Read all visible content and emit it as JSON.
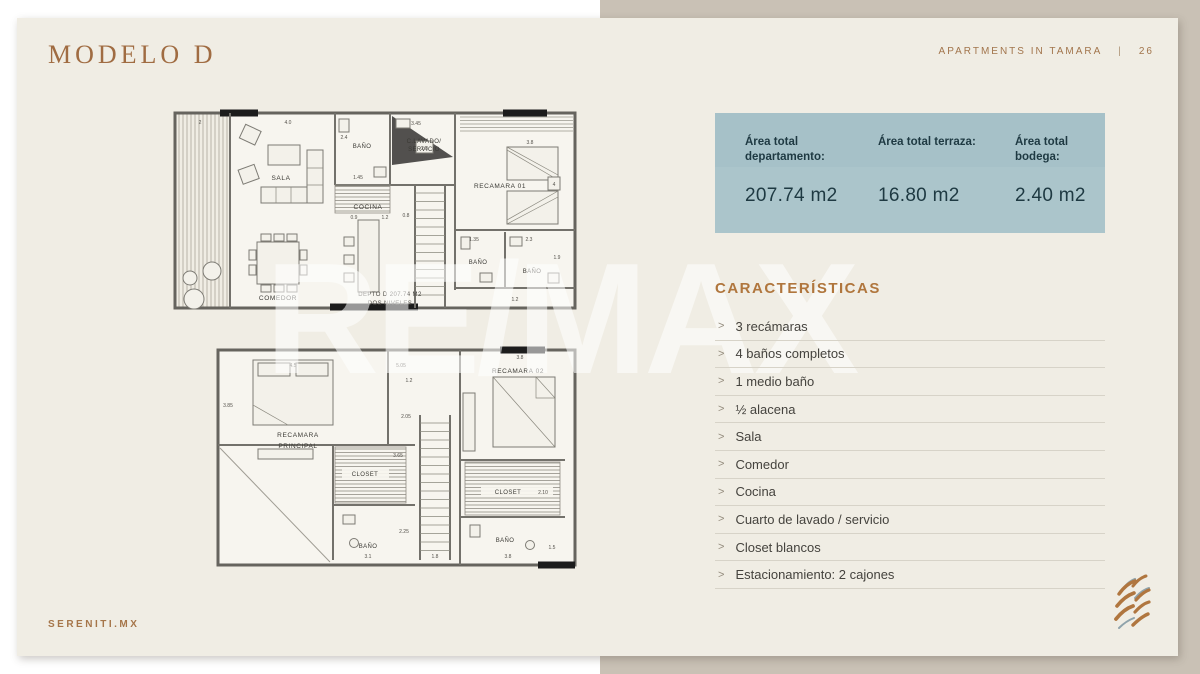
{
  "header": {
    "title": "MODELO D",
    "project": "APARTMENTS IN TAMARA",
    "separator": "|",
    "page_number": "26"
  },
  "watermark": "RE/MAX",
  "footer": {
    "website": "SERENITI.MX"
  },
  "colors": {
    "accent_brown": "#a2754c",
    "table_blue": "#a9c3c9",
    "table_text": "#1e3942",
    "card_bg": "#f0ede4",
    "right_bg": "#c9c1b5"
  },
  "areas": {
    "columns": [
      {
        "label": "Área total departamento:",
        "value": "207.74 m2"
      },
      {
        "label": "Área total terraza:",
        "value": "16.80 m2"
      },
      {
        "label": "Área total bodega:",
        "value": "2.40 m2"
      }
    ]
  },
  "characteristics": {
    "title": "CARACTERÍSTICAS",
    "bullet": ">",
    "items": [
      "3 recámaras",
      "4 baños completos",
      "1 medio baño",
      "½ alacena",
      "Sala",
      "Comedor",
      "Cocina",
      "Cuarto de lavado / servicio",
      "Closet blancos",
      "Estacionamiento: 2 cajones"
    ]
  },
  "floorplan": {
    "level1": {
      "sala": "SALA",
      "bano_top": "BAÑO",
      "lavado_line1": "C.LAVADO/",
      "lavado_line2": "SERVICIO",
      "cocina": "COCINA",
      "recamara01": "RECAMARA 01",
      "recamara01_box": "4",
      "bano_mid1": "BAÑO",
      "bano_mid2": "BAÑO",
      "comedor": "COMEDOR",
      "caption_line1": "DEPTO D 207.74 M2",
      "caption_line2": "DOS NIVELES",
      "dims": {
        "d1": "2",
        "d2": "4.0",
        "d3": "3.45",
        "d4": "2.4",
        "d5": "1.45",
        "d6": "0.9",
        "d7": "1.2",
        "d8": "0.8",
        "d9": "3.8",
        "d10": "2.8",
        "d11": "1.35",
        "d12": "2.3",
        "d13": "1.9",
        "d14": "1.2"
      }
    },
    "level2": {
      "recamara_ppal_line1": "RECAMARA",
      "recamara_ppal_line2": "PRINCIPAL",
      "closet_left": "CLOSET",
      "bano_left": "BAÑO",
      "recamara02": "RECAMARA 02",
      "closet_right": "CLOSET",
      "bano_right": "BAÑO",
      "dims": {
        "d1": "3.85",
        "d2": "4.5",
        "d3": "5.05",
        "d4": "1.2",
        "d5": "3.8",
        "d6": "2.05",
        "d7": "3.65",
        "d8": "2.25",
        "d9": "3.1",
        "d10": "1.8",
        "d11": "2.10",
        "d12": "1.5",
        "d13": "3.8"
      }
    }
  }
}
